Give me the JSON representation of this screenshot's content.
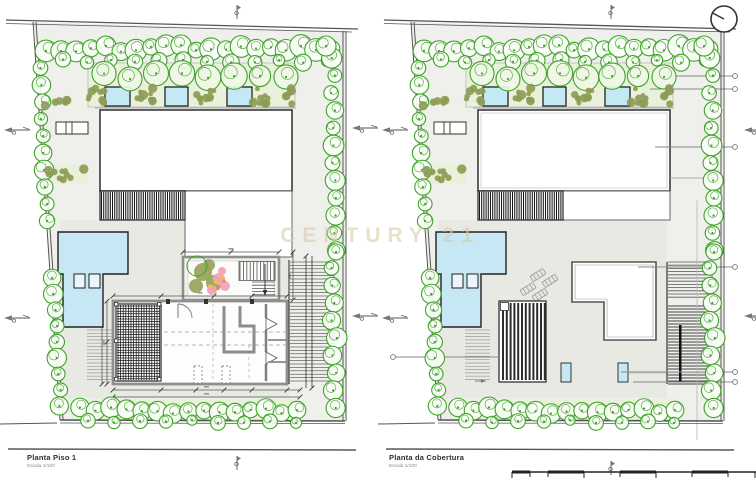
{
  "watermark": {
    "text": "CENTURY 21"
  },
  "plans": [
    {
      "id": "floor",
      "title": "Planta Piso 1",
      "scale": "Escala 1/100"
    },
    {
      "id": "roof",
      "title": "Planta da Cobertura",
      "scale": "Escala 1/100"
    }
  ],
  "colors": {
    "site": "#efefec",
    "deck": "#e9e9e4",
    "planter": "#e9f1db",
    "tree_stroke": "#3da327",
    "tree_fill": "#fbfdf8",
    "tree_fill_light": "#f0f7e7",
    "shrub": "#8d9c55",
    "pool": "#c6e7f3",
    "skylight": "#c5e8f5",
    "water_line": "#2ec6d8",
    "wall": "#8f8f8f",
    "dark": "#3a3a3a",
    "hatch": "#161616",
    "road": "#555555",
    "dim": "#555555",
    "leader": "#888888",
    "blossom_olive": "#9aa55e",
    "blossom_pink": "#f0a3b8",
    "blossom_orange": "#e2952f",
    "blossom_yellow": "#e8c43c",
    "watermark": "#d8cba4"
  }
}
